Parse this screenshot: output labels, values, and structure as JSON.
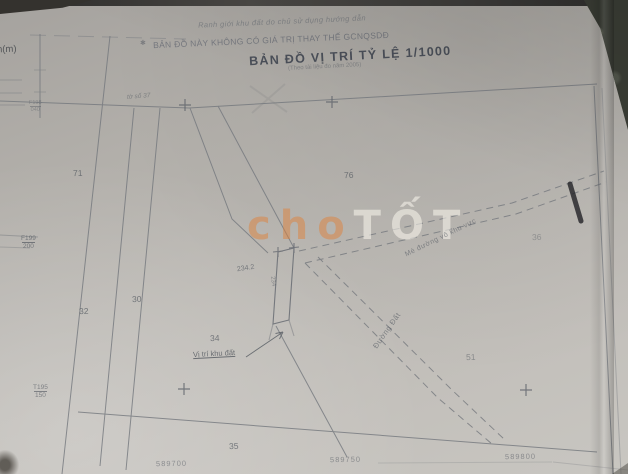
{
  "header": {
    "elevation_unit": "h(m)",
    "boundary_note": "Ranh giới khu đất do chủ sử dụng hướng dẫn",
    "disclaimer_mark": "✱",
    "disclaimer": "BẢN ĐỒ NÀY KHÔNG CÓ GIÁ TRỊ THAY THẾ GCNQSDĐ",
    "title": "BẢN ĐỒ VỊ TRÍ TỶ LỆ 1/1000",
    "subtitle": "(Theo tài liệu đo năm 2005)",
    "sheet_note": "tờ số 37"
  },
  "markers": {
    "top": {
      "name": "F198",
      "value": "040"
    },
    "mid": {
      "name": "F199",
      "value": "200"
    },
    "bottom": {
      "name": "T195",
      "value": "150"
    }
  },
  "parcels": [
    {
      "label": "71"
    },
    {
      "label": "76"
    },
    {
      "label": "30"
    },
    {
      "label": "32"
    },
    {
      "label": "34"
    },
    {
      "label": "35"
    },
    {
      "label": "51"
    },
    {
      "label": "36"
    }
  ],
  "plot": {
    "area_label": "234.2",
    "inner_label": "234",
    "callout": "Vị trí khu đất"
  },
  "roads": {
    "access_road_label": "Mé đường vô khu vực",
    "dirt_road_label": "Đường Đất"
  },
  "coordinates": [
    "589700",
    "589750",
    "589800"
  ],
  "watermark": {
    "part_cho": "cho",
    "part_tot": "TỐT"
  },
  "colors": {
    "paper": "#bcb9b4",
    "map_line": "#72767c",
    "ink": "#4d535c",
    "watermark_orange": "#de823c",
    "watermark_white": "#f6f3eb",
    "pen_mark": "#26262a"
  }
}
